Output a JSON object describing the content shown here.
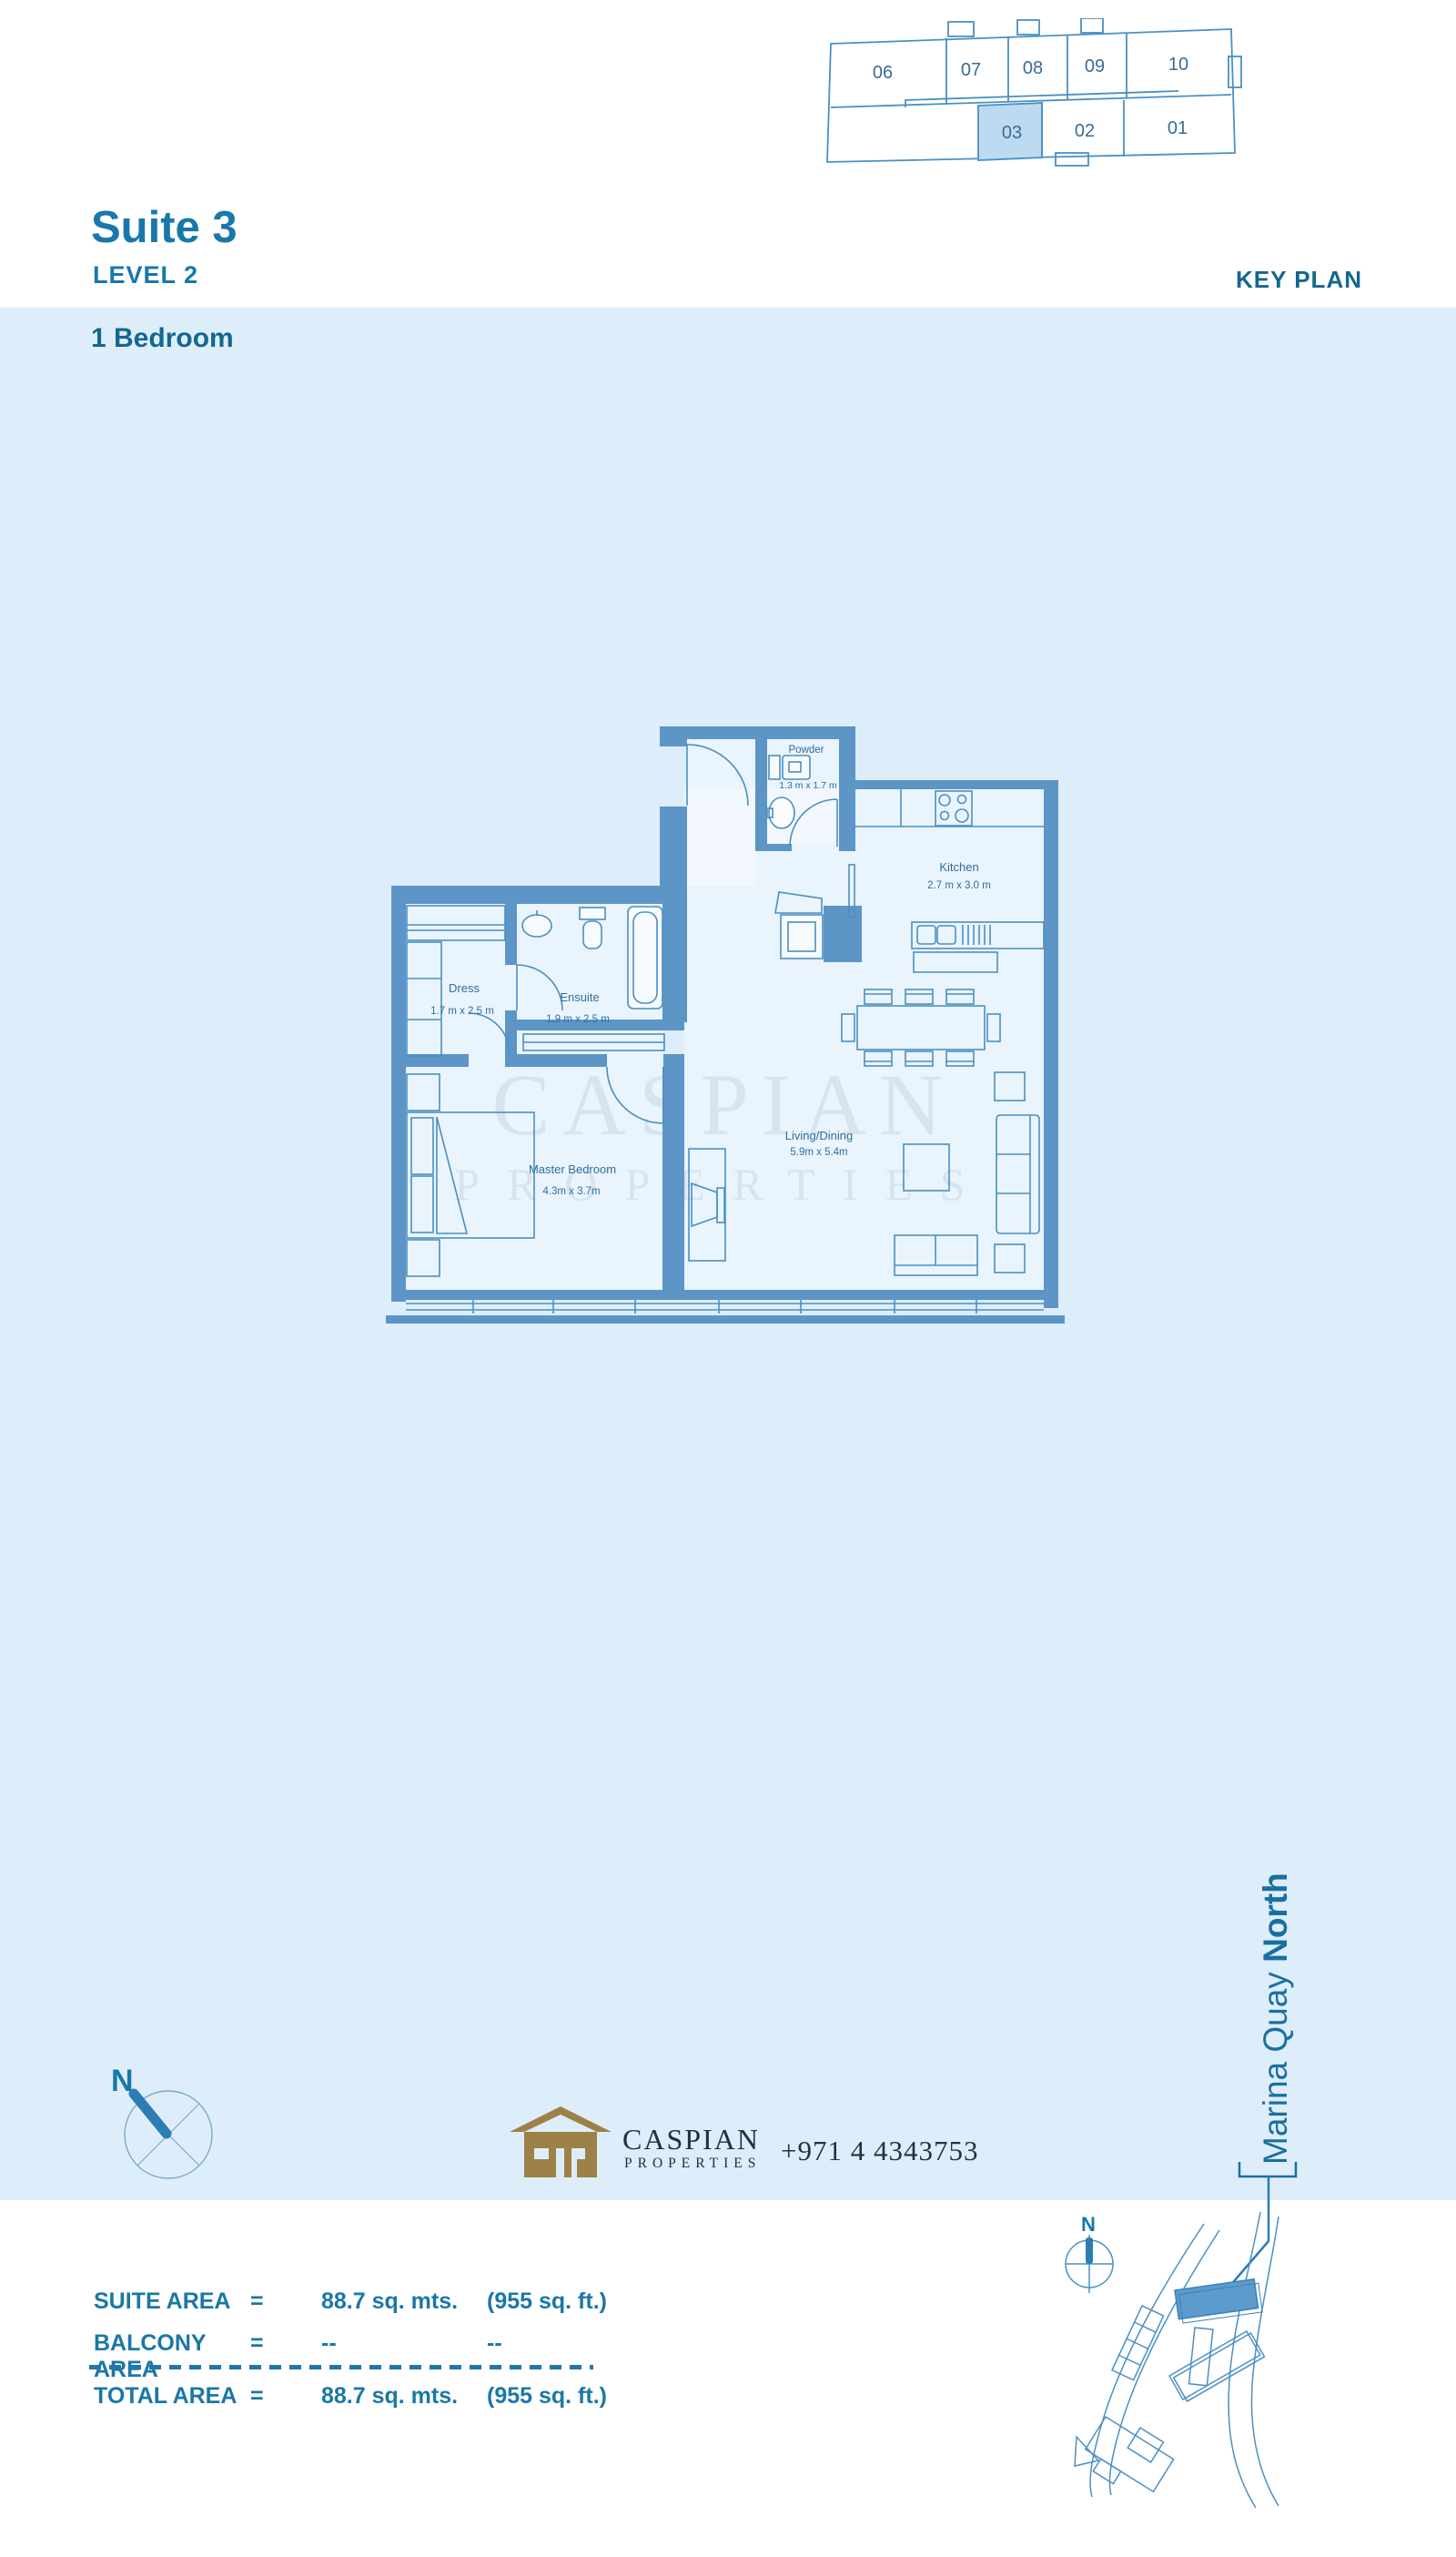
{
  "header": {
    "suite_title": "Suite 3",
    "level": "LEVEL 2",
    "key_plan_label": "KEY PLAN",
    "bedroom_label": "1 Bedroom"
  },
  "key_plan": {
    "top_row": [
      "06",
      "07",
      "08",
      "09",
      "10"
    ],
    "bottom_row": [
      "03",
      "02",
      "01"
    ],
    "highlighted_unit": "03"
  },
  "floor_plan": {
    "rooms": [
      {
        "name": "Powder",
        "dims": "1.3 m x 1.7 m"
      },
      {
        "name": "Kitchen",
        "dims": "2.7 m x 3.0 m"
      },
      {
        "name": "Dress",
        "dims": "1.7 m x 2.5 m"
      },
      {
        "name": "Ensuite",
        "dims": "1.9 m x 2.5 m"
      },
      {
        "name": "Master Bedroom",
        "dims": "4.3m x 3.7m"
      },
      {
        "name": "Living/Dining",
        "dims": "5.9m x 5.4m"
      }
    ]
  },
  "watermark": {
    "line1": "CASPIAN",
    "line2": "PROPERTIES"
  },
  "compass": {
    "label": "N"
  },
  "logo": {
    "name": "CASPIAN",
    "tagline": "PROPERTIES",
    "phone": "+971 4 4343753"
  },
  "location": {
    "building_label_regular": "Marina Quay ",
    "building_label_bold": "North",
    "map_compass_label": "N"
  },
  "area_table": {
    "rows": [
      {
        "label": "SUITE AREA",
        "eq": "=",
        "metric": "88.7 sq. mts.",
        "imperial": "(955 sq. ft.)"
      },
      {
        "label": "BALCONY AREA",
        "eq": "=",
        "metric": "--",
        "imperial": "--"
      },
      {
        "label": "TOTAL AREA",
        "eq": "=",
        "metric": "88.7 sq. mts.",
        "imperial": "(955 sq. ft.)"
      }
    ]
  },
  "colors": {
    "page_band": "#ddeefa",
    "heading_blue": "#1878ab",
    "text_blue": "#1a78a6",
    "plan_wall": "#5d95c7",
    "plan_line": "#4a8fc2",
    "keyplan_highlight": "#bedaf0",
    "watermark": "#bfd3e4",
    "logo_gold": "#9d8148",
    "needle_blue": "#2d7cb4"
  }
}
